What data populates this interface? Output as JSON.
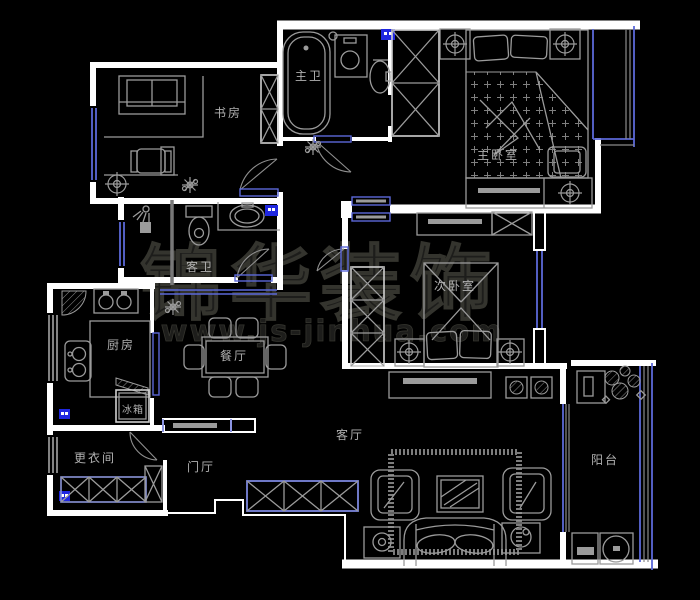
{
  "watermark": {
    "line1": "锦华装饰",
    "line2": "www.js-jinhua.com"
  },
  "rooms": {
    "study": {
      "label": "书房"
    },
    "master_bath": {
      "label": "主卫"
    },
    "master_bedroom": {
      "label": "主卧室"
    },
    "guest_bath": {
      "label": "客卫"
    },
    "bedroom2": {
      "label": "次卧室"
    },
    "kitchen": {
      "label": "厨房"
    },
    "fridge": {
      "label": "冰箱"
    },
    "dining": {
      "label": "餐厅"
    },
    "dressing": {
      "label": "更衣间"
    },
    "hall": {
      "label": "门厅"
    },
    "living": {
      "label": "客厅"
    },
    "balcony": {
      "label": "阳台"
    }
  },
  "colors": {
    "background": "#000000",
    "wall": "#ffffff",
    "furniture": "#9b9b9b",
    "window": "#5b68d8",
    "marker": "#1f27e0",
    "label": "#b0b0b0",
    "watermark": "#1d1d1b"
  }
}
